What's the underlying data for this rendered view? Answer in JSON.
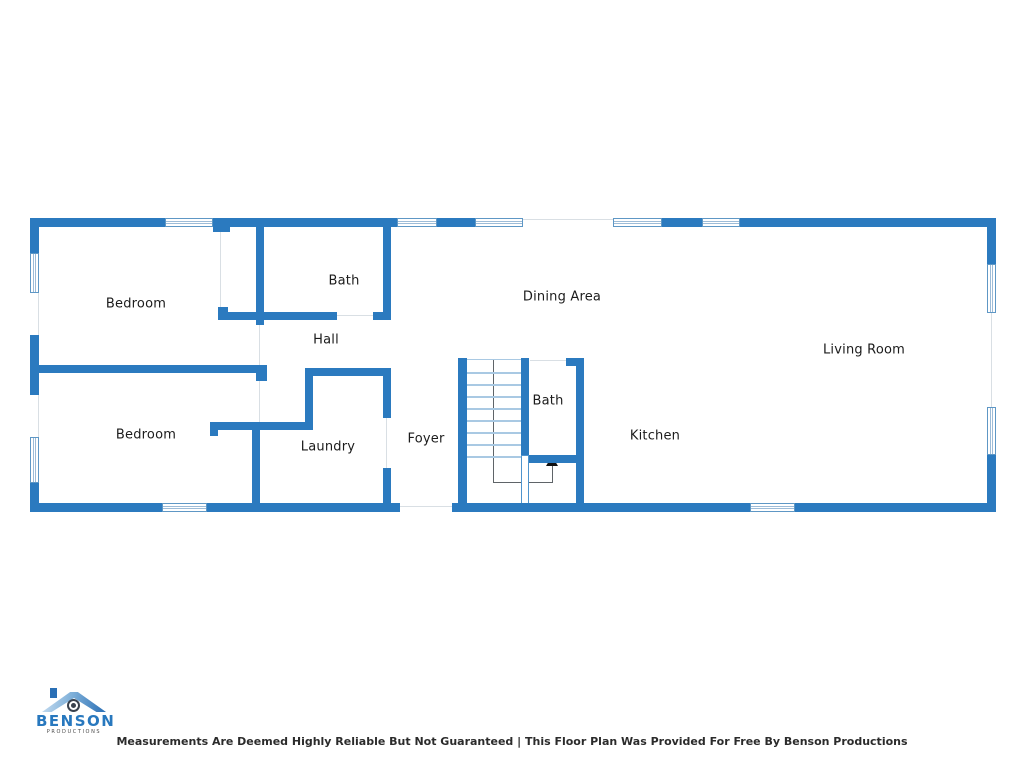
{
  "rooms": [
    {
      "id": "bedroom-1",
      "label": "Bedroom"
    },
    {
      "id": "bath-1",
      "label": "Bath"
    },
    {
      "id": "hall",
      "label": "Hall"
    },
    {
      "id": "dining-area",
      "label": "Dining Area"
    },
    {
      "id": "living-room",
      "label": "Living Room"
    },
    {
      "id": "bedroom-2",
      "label": "Bedroom"
    },
    {
      "id": "laundry",
      "label": "Laundry"
    },
    {
      "id": "foyer",
      "label": "Foyer"
    },
    {
      "id": "bath-2",
      "label": "Bath"
    },
    {
      "id": "kitchen",
      "label": "Kitchen"
    }
  ],
  "footer": {
    "disclaimer": "Measurements Are Deemed Highly Reliable But Not Guaranteed | This Floor Plan Was Provided For Free By Benson Productions"
  },
  "logo": {
    "name": "BENSON",
    "subtitle": "PRODUCTIONS"
  },
  "colors": {
    "wall_blue": "#2b7abf",
    "window_frame": "#5e97c5",
    "stair_tread_blue": "#a9c9e3",
    "logo_blue": "#2878be"
  }
}
